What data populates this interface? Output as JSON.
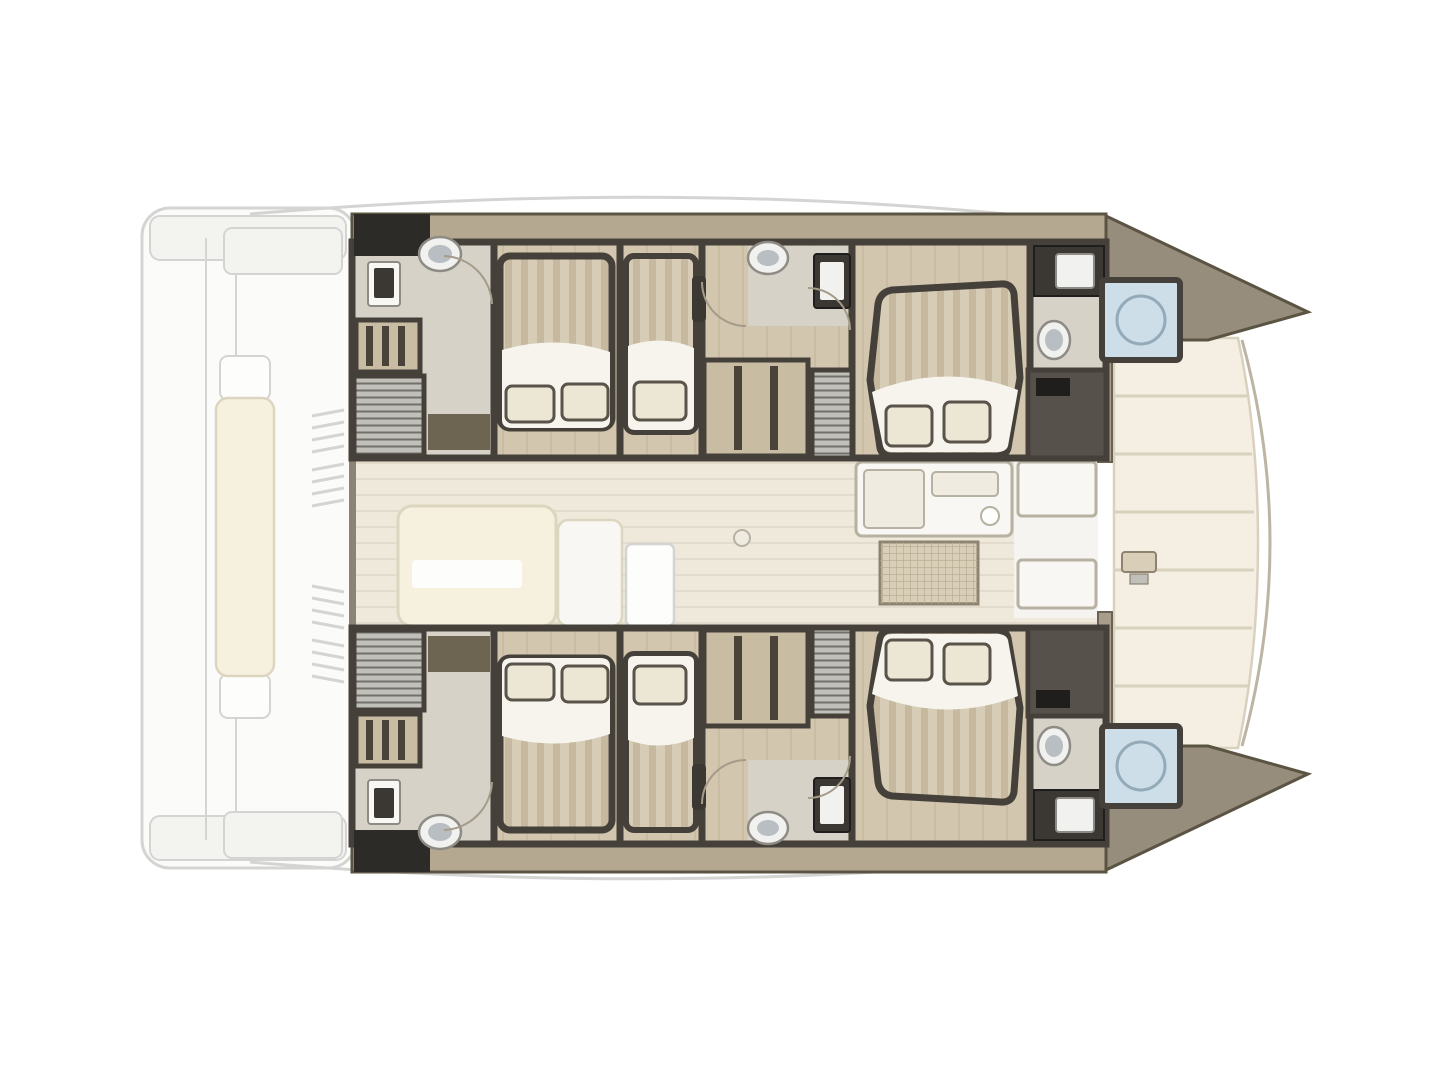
{
  "document": {
    "type": "yacht deck plan",
    "subject": "Catamaran interior layout floor plan, top-down view, bow facing right, stern (aft cockpit) ghosted at left",
    "visible_text": [],
    "background": "#ffffff"
  },
  "colors": {
    "background": "#ffffff",
    "ghost-line": "#d4d4d2",
    "ghost-fill": "#fbfbfa",
    "davit-fill": "#f3f3f0",
    "bench-cream": "#f6f1de",
    "bench-line": "#dcd5bf",
    "white": "#fdfdfc",
    "wall": "#45403a",
    "band": "#b4a990",
    "band-edge": "#5b5443",
    "bow-taupe": "#978d7d",
    "bath-floor": "#d7d2c8",
    "wood-floor": "#d2c6ae",
    "wood-line": "#c2b59b",
    "deck-floor": "#efe9dc",
    "deck-stripe": "#e3dbcb",
    "deck-wall": "#8b8374",
    "passage-white": "#f5f4f0",
    "mattress": "#d7ccb6",
    "mattress-stripe": "#c6b99f",
    "duvet": "#f6f4ed",
    "pillow": "#ece6d5",
    "pillow-line": "#59534a",
    "frame-dark": "#49433a",
    "charcoal": "#3b3833",
    "locker-dark": "#2d2b28",
    "shelf-tan": "#c8bca3",
    "stair-gray": "#c1bfb9",
    "stair-line": "#73706a",
    "mat-brown": "#6e6452",
    "toilet-white": "#f1f1ef",
    "toilet-gray": "#b9bec3",
    "fixture-line": "#8e8b85",
    "shower-blue": "#cddee9",
    "shower-ring": "#93aab8",
    "tech-gray": "#56524b",
    "black-accent": "#1f1e1c",
    "galley-white": "#f8f7f3",
    "counter-line": "#b7b1a2",
    "counter-inner": "#efebe1",
    "grid-tan": "#d9cfb8",
    "grid-line": "#b3a78c",
    "grid-edge": "#8e8370",
    "foredeck-cream": "#f4efe2",
    "foredeck-line": "#d8d1be",
    "forestay": "#bdb5a4",
    "bulkhead": "#a79d8a",
    "bulkhead-edge": "#6a6254",
    "door-line": "#a59b89"
  },
  "inventory": {
    "hulls": [
      "port hull (top)",
      "starboard hull (bottom, mirror of port)"
    ],
    "double_bed_cabins": 4,
    "single_berths": 2,
    "toilets": 4,
    "wash_basins": 6,
    "bow_shower_rooms": 2,
    "companionway_stairs": 4,
    "wardrobes_shelving": 4,
    "saloon_sofa": 1,
    "galley_counters": 3,
    "saloon_table_grid": 1,
    "foredeck_lounge": 1,
    "aft_cockpit": "ghosted outline with center bench, roof supports and swim platforms"
  }
}
